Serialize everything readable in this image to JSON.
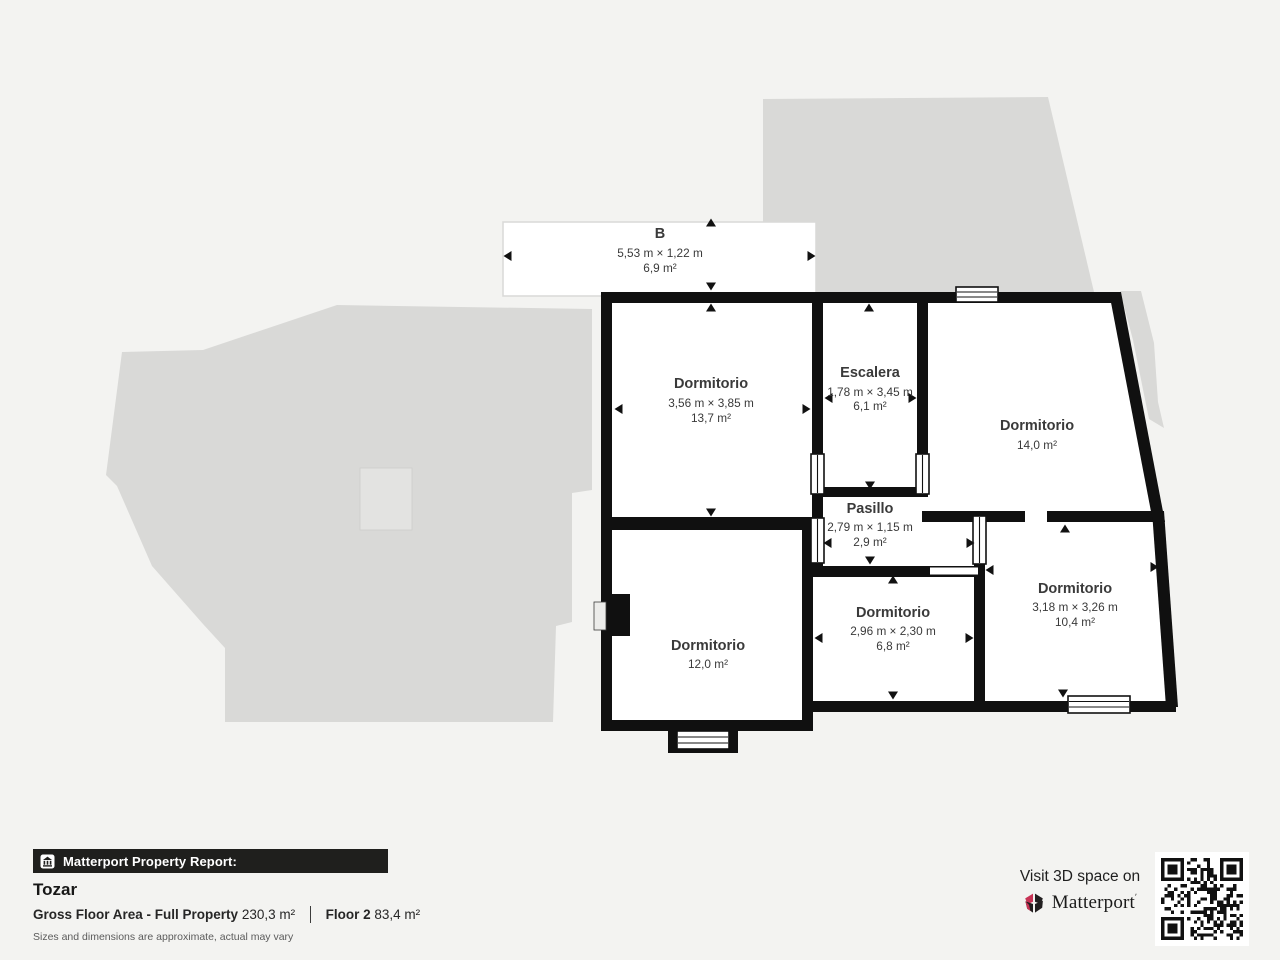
{
  "floorplan": {
    "rooms": [
      {
        "key": "balcony-b",
        "label": "B",
        "dims": "5,53 m × 1,22 m",
        "area": "6,9 m²"
      },
      {
        "key": "dormitorio-nw",
        "label": "Dormitorio",
        "dims": "3,56 m × 3,85 m",
        "area": "13,7 m²"
      },
      {
        "key": "escalera",
        "label": "Escalera",
        "dims": "1,78 m × 3,45 m",
        "area": "6,1 m²"
      },
      {
        "key": "dormitorio-ne",
        "label": "Dormitorio",
        "dims": "",
        "area": "14,0 m²"
      },
      {
        "key": "pasillo",
        "label": "Pasillo",
        "dims": "2,79 m × 1,15 m",
        "area": "2,9 m²"
      },
      {
        "key": "dormitorio-sw",
        "label": "Dormitorio",
        "dims": "",
        "area": "12,0 m²"
      },
      {
        "key": "dormitorio-s",
        "label": "Dormitorio",
        "dims": "2,96 m × 2,30 m",
        "area": "6,8 m²"
      },
      {
        "key": "dormitorio-se",
        "label": "Dormitorio",
        "dims": "3,18 m × 3,26 m",
        "area": "10,4 m²"
      }
    ]
  },
  "report": {
    "bar_label": "Matterport Property Report:",
    "property_name": "Tozar",
    "gfa_label": "Gross Floor Area - Full Property",
    "gfa_value": "230,3 m²",
    "floor_label": "Floor 2",
    "floor_value": "83,4 m²",
    "disclaimer": "Sizes and dimensions are approximate, actual may vary"
  },
  "cta": {
    "visit_label": "Visit 3D space on",
    "brand": "Matterport"
  },
  "colors": {
    "wall": "#101010",
    "silhouette": "#d9d9d7",
    "patio": "#e3e3e1",
    "background": "#f3f3f1",
    "accent_red": "#c73355"
  }
}
